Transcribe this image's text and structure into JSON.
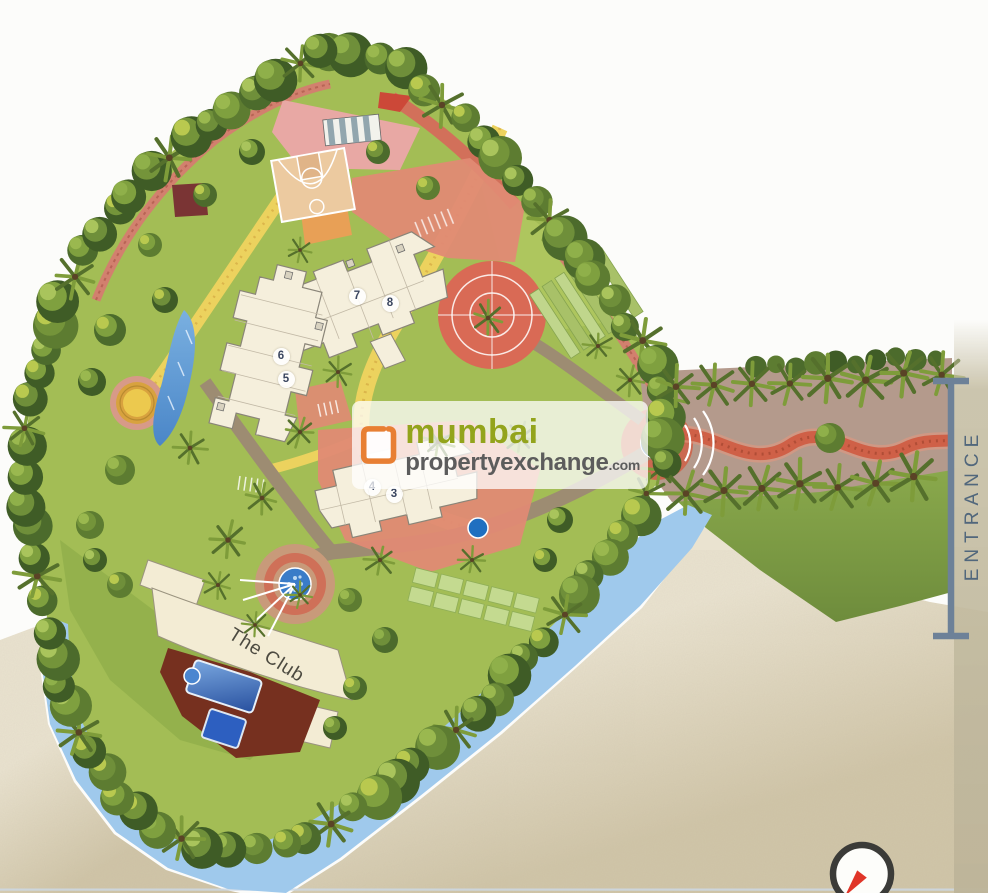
{
  "plan": {
    "buildings": [
      {
        "label": "3"
      },
      {
        "label": "4"
      },
      {
        "label": "5"
      },
      {
        "label": "6"
      },
      {
        "label": "7"
      },
      {
        "label": "8"
      }
    ],
    "club_label": "The Club",
    "entrance_label": "ENTRANCE"
  },
  "watermark": {
    "word1": "mumbai",
    "word2": "propertyexchange",
    "tld": ".com"
  },
  "icons": {
    "logo": "mumbai-property-exchange-logo",
    "compass": "compass-needle-icon",
    "entrance_bracket": "entrance-extent-bracket"
  },
  "colors": {
    "logo_orange": "#e87f33",
    "brand_green": "#93a41c",
    "brand_gray": "#5c5c5c",
    "water_blue": "#9fc9ec",
    "lawn_green": "#a3bd55",
    "tree_dark_green": "#3f5c26",
    "entrance_road": "#b49a8c",
    "brick_red": "#cf6047",
    "building_cream": "#f5efdc",
    "pool_blue": "#2d5fc0",
    "paper_beige": "#d8cdb2",
    "track_pink": "#d2806e",
    "path_yellow": "#ecd25e",
    "compass_needle_red": "#e03528"
  }
}
